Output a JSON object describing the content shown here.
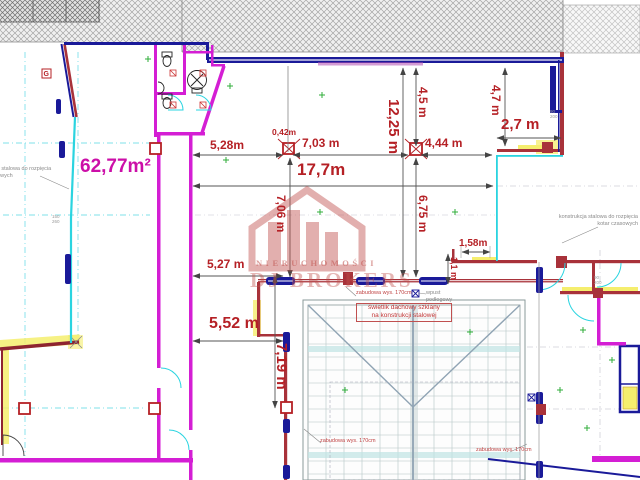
{
  "dims": {
    "area": "62,77m²",
    "w528": "5,28m",
    "w042": "0,42m",
    "w703": "7,03 m",
    "w444": "4,44 m",
    "w27": "2,7 m",
    "w177": "17,7m",
    "w527": "5,27 m",
    "w552": "5,52 m",
    "w158": "1,58m",
    "h1225": "12,25 m",
    "h45": "4,5 m",
    "h47": "4,7 m",
    "h706": "7,06 m",
    "h675": "6,75 m",
    "h719": "7,19 m",
    "h11": "1,1 m"
  },
  "annotations": {
    "skylight_l1": "świetlik dachowy szklany",
    "skylight_l2": "na konstrukcji stalowej",
    "zabudowa": "zabudowa wys. 170cm",
    "wpust": "wpust\npodłogowy",
    "steel_structure": "konstrukcja stalowa do rozpięcia\nkotar czasowych",
    "g_mark": "G",
    "door_size": "90\n200",
    "window_size": "150\n260"
  },
  "watermark": {
    "line1": "NIERUCHOMOŚCI",
    "line2": "DJ BROKERS"
  },
  "colors": {
    "wall_navy": "#1a1a99",
    "wall_magenta": "#d41ed4",
    "wall_crimson": "#a8323a",
    "wall_cyan": "#2ad4e0",
    "dim_red": "#b52025",
    "area_magenta": "#cc0fa8",
    "highlight_yellow": "#f5ee6e",
    "watermark_red": "#c0504d",
    "marker_green": "#2fae3a"
  }
}
